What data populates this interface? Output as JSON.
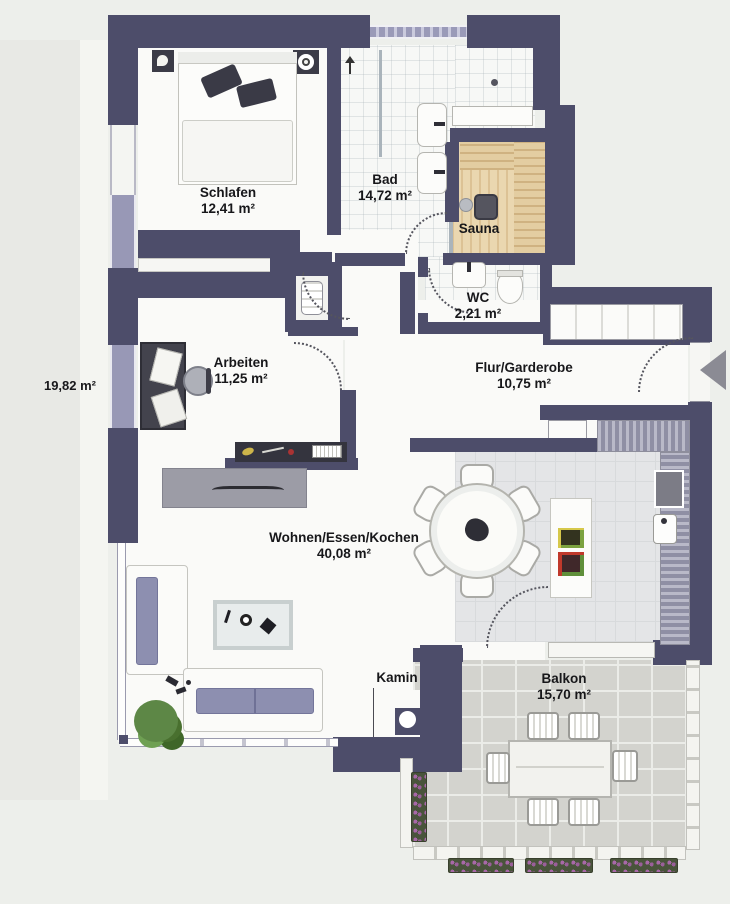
{
  "plan": {
    "title": "Apartment floor plan",
    "rooms": [
      {
        "name": "Schlafen",
        "area": "12,41 m²"
      },
      {
        "name": "Bad",
        "area": "14,72 m²"
      },
      {
        "name": "Sauna",
        "area": ""
      },
      {
        "name": "WC",
        "area": "2,21 m²"
      },
      {
        "name": "Arbeiten",
        "area": "11,25 m²"
      },
      {
        "name": "Flur/Garderobe",
        "area": "10,75 m²"
      },
      {
        "name": "Wohnen/Essen/Kochen",
        "area": "40,08 m²"
      },
      {
        "name": "Balkon",
        "area": "15,70 m²"
      }
    ],
    "features": {
      "kamin": "Kamin"
    },
    "outside_area": "19,82 m²",
    "colors": {
      "wall": "#4d4d6a",
      "window": "#9a9ab8",
      "floor": "#fafaf8",
      "kitchen_floor": "#e4e5e7",
      "sauna_wood": "#ead7b0",
      "paving": "#d3d3ce",
      "sofa_cushion": "#8d8fb0",
      "paper": "#edefeb"
    }
  }
}
